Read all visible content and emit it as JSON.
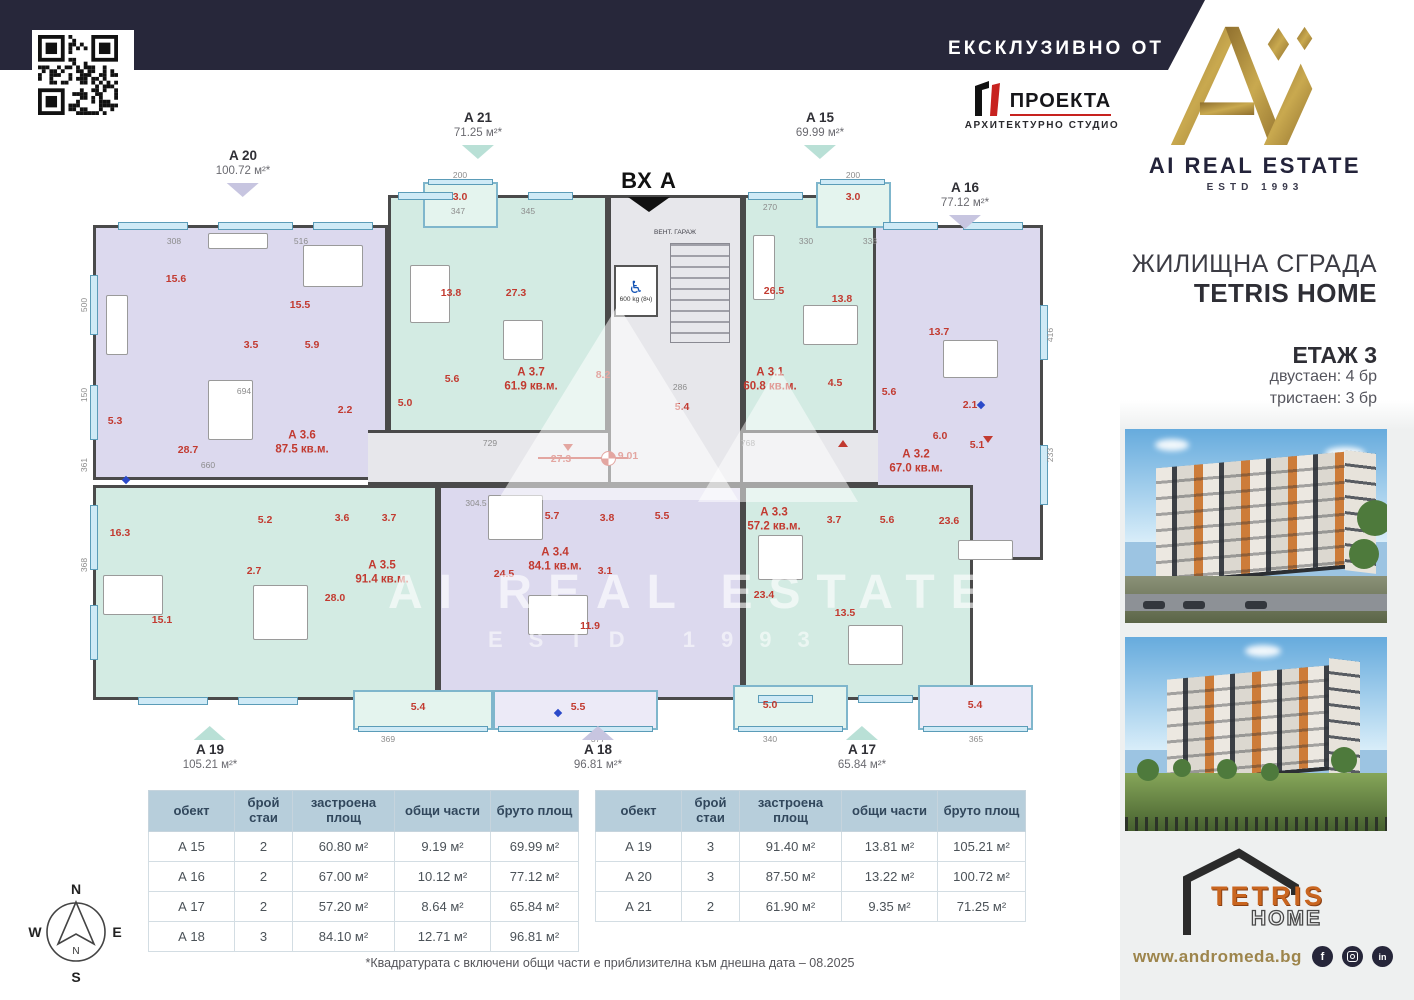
{
  "topbar": {
    "exclusive": "ЕКСКЛУЗИВНО ОТ"
  },
  "proekta": {
    "name": "ПРОЕКТА",
    "subtitle": "АРХИТЕКТУРНО СТУДИО"
  },
  "brand": {
    "name": "AI REAL ESTATE",
    "estd": "ESTD 1993"
  },
  "sidebar": {
    "title1": "ЖИЛИЩНА СГРАДА",
    "title2": "TETRIS HOME",
    "floor": "ЕТАЖ 3",
    "units_line1": "двустаен: 4 бр",
    "units_line2": "тристаен: 3 бр",
    "website": "www.andromeda.bg",
    "tetris": {
      "word1": "TETRIS",
      "word2": "HOME"
    },
    "socials": [
      {
        "name": "facebook",
        "glyph": "f"
      },
      {
        "name": "instagram",
        "glyph": ""
      },
      {
        "name": "linkedin",
        "glyph": "in"
      }
    ]
  },
  "plan": {
    "entrance": "ВХ А",
    "vent": "ВЕНТ. ГАРАЖ",
    "elevator": "600 kg (8ч)",
    "benchmark": "9.01",
    "watermark1": "AI REAL ESTATE",
    "watermark2": "ESTD 1993",
    "colors": {
      "teal": "#d3ebe3",
      "lavender": "#dcd9ee",
      "tealLight": "#e4f4ee",
      "lavenderLight": "#eceaf7",
      "corridor": "#e7e7eb",
      "wall": "#4a4a4a",
      "room": "#c23a30",
      "dim": "#8c8c8c",
      "markerTeal": "#b9e0d6",
      "markerLavender": "#c7c5e0"
    },
    "markers": [
      {
        "name": "A 20",
        "area": "100.72 м²*",
        "color": "lavender",
        "dir": "down",
        "x": 243,
        "y": 148
      },
      {
        "name": "A 21",
        "area": "71.25 м²*",
        "color": "teal",
        "dir": "down",
        "x": 478,
        "y": 110
      },
      {
        "name": "A 15",
        "area": "69.99 м²*",
        "color": "teal",
        "dir": "down",
        "x": 820,
        "y": 110
      },
      {
        "name": "A 16",
        "area": "77.12 м²*",
        "color": "lavender",
        "dir": "down",
        "x": 965,
        "y": 180
      },
      {
        "name": "A 19",
        "area": "105.21 м²*",
        "color": "teal",
        "dir": "up",
        "x": 210,
        "y": 722
      },
      {
        "name": "A 18",
        "area": "96.81 м²*",
        "color": "lavender",
        "dir": "up",
        "x": 598,
        "y": 722
      },
      {
        "name": "A 17",
        "area": "65.84 м²*",
        "color": "teal",
        "dir": "up",
        "x": 862,
        "y": 722
      }
    ],
    "units": [
      {
        "label": "А 3.6",
        "area": "87.5 кв.м.",
        "color": "lavender",
        "rect": [
          35,
          80,
          295,
          255
        ],
        "lx": 244,
        "ly": 298,
        "rooms": [
          {
            "v": "15.6",
            "x": 118,
            "y": 134
          },
          {
            "v": "15.5",
            "x": 242,
            "y": 160
          },
          {
            "v": "3.5",
            "x": 193,
            "y": 200
          },
          {
            "v": "5.9",
            "x": 254,
            "y": 200
          },
          {
            "v": "28.7",
            "x": 130,
            "y": 305
          },
          {
            "v": "5.3",
            "x": 57,
            "y": 276
          },
          {
            "v": "2.2",
            "x": 287,
            "y": 265
          }
        ]
      },
      {
        "label": "А 3.7",
        "area": "61.9 кв.м.",
        "color": "teal",
        "rect": [
          330,
          50,
          220,
          255
        ],
        "lx": 473,
        "ly": 235,
        "rooms": [
          {
            "v": "13.8",
            "x": 393,
            "y": 148
          },
          {
            "v": "27.3",
            "x": 458,
            "y": 148
          },
          {
            "v": "5.6",
            "x": 394,
            "y": 234
          },
          {
            "v": "5.0",
            "x": 347,
            "y": 258
          }
        ]
      },
      {
        "label": "А 3.1",
        "area": "60.8 кв.м.",
        "color": "teal",
        "rect": [
          685,
          50,
          145,
          255
        ],
        "lx": 712,
        "ly": 235,
        "rooms": [
          {
            "v": "26.5",
            "x": 716,
            "y": 146
          },
          {
            "v": "13.8",
            "x": 784,
            "y": 154
          },
          {
            "v": "4.5",
            "x": 777,
            "y": 238
          },
          {
            "v": "5.6",
            "x": 831,
            "y": 247
          }
        ]
      },
      {
        "label": "А 3.2",
        "area": "67.0 кв.м.",
        "color": "lavender",
        "rect": [
          815,
          80,
          170,
          335
        ],
        "lx": 858,
        "ly": 317,
        "rooms": [
          {
            "v": "13.7",
            "x": 881,
            "y": 187
          },
          {
            "v": "2.1",
            "x": 912,
            "y": 260
          },
          {
            "v": "6.0",
            "x": 882,
            "y": 291
          },
          {
            "v": "5.1",
            "x": 919,
            "y": 300
          },
          {
            "v": "23.6",
            "x": 891,
            "y": 376
          }
        ]
      },
      {
        "label": "А 3.5",
        "area": "91.4 кв.м.",
        "color": "teal",
        "rect": [
          35,
          340,
          345,
          215
        ],
        "lx": 324,
        "ly": 428,
        "rooms": [
          {
            "v": "16.3",
            "x": 62,
            "y": 388
          },
          {
            "v": "5.2",
            "x": 207,
            "y": 375
          },
          {
            "v": "3.6",
            "x": 284,
            "y": 373
          },
          {
            "v": "3.7",
            "x": 331,
            "y": 373
          },
          {
            "v": "2.7",
            "x": 196,
            "y": 426
          },
          {
            "v": "15.1",
            "x": 104,
            "y": 475
          },
          {
            "v": "28.0",
            "x": 277,
            "y": 453
          }
        ]
      },
      {
        "label": "А 3.4",
        "area": "84.1 кв.м.",
        "color": "lavender",
        "rect": [
          380,
          340,
          305,
          215
        ],
        "lx": 497,
        "ly": 415,
        "rooms": [
          {
            "v": "5.7",
            "x": 494,
            "y": 371
          },
          {
            "v": "3.8",
            "x": 549,
            "y": 373
          },
          {
            "v": "5.5",
            "x": 604,
            "y": 371
          },
          {
            "v": "24.5",
            "x": 446,
            "y": 429
          },
          {
            "v": "3.1",
            "x": 547,
            "y": 426
          },
          {
            "v": "11.9",
            "x": 532,
            "y": 481
          }
        ]
      },
      {
        "label": "А 3.3",
        "area": "57.2 кв.м.",
        "color": "teal",
        "rect": [
          685,
          340,
          230,
          215
        ],
        "lx": 716,
        "ly": 375,
        "rooms": [
          {
            "v": "3.7",
            "x": 776,
            "y": 375
          },
          {
            "v": "5.6",
            "x": 829,
            "y": 375
          },
          {
            "v": "23.4",
            "x": 706,
            "y": 450
          },
          {
            "v": "13.5",
            "x": 787,
            "y": 468
          }
        ]
      }
    ],
    "balconies": [
      {
        "v": "3.0",
        "color": "tealLight",
        "rect": [
          365,
          37,
          75,
          46
        ],
        "lx": 402,
        "ly": 52
      },
      {
        "v": "3.0",
        "color": "tealLight",
        "rect": [
          758,
          37,
          75,
          46
        ],
        "lx": 795,
        "ly": 52
      },
      {
        "v": "5.4",
        "color": "tealLight",
        "rect": [
          295,
          545,
          140,
          40
        ],
        "lx": 360,
        "ly": 562
      },
      {
        "v": "5.5",
        "color": "lavenderLight",
        "rect": [
          435,
          545,
          165,
          40
        ],
        "lx": 520,
        "ly": 562
      },
      {
        "v": "5.0",
        "color": "tealLight",
        "rect": [
          675,
          540,
          115,
          45
        ],
        "lx": 712,
        "ly": 560
      },
      {
        "v": "5.4",
        "color": "lavenderLight",
        "rect": [
          860,
          540,
          115,
          45
        ],
        "lx": 917,
        "ly": 560
      }
    ],
    "hall": {
      "rect": [
        310,
        285,
        510,
        55
      ],
      "labels": [
        {
          "v": "27.3",
          "x": 503,
          "y": 314
        },
        {
          "v": "9.01",
          "x": 570,
          "y": 311
        }
      ]
    },
    "core": {
      "rect": [
        550,
        50,
        135,
        290
      ],
      "labels": [
        {
          "v": "8.2",
          "x": 545,
          "y": 230
        },
        {
          "v": "5.4",
          "x": 624,
          "y": 262
        }
      ]
    },
    "dims": [
      {
        "v": "308",
        "x": 116,
        "y": 96
      },
      {
        "v": "516",
        "x": 243,
        "y": 96
      },
      {
        "v": "347",
        "x": 400,
        "y": 66
      },
      {
        "v": "345",
        "x": 470,
        "y": 66
      },
      {
        "v": "200",
        "x": 402,
        "y": 30
      },
      {
        "v": "200",
        "x": 795,
        "y": 30
      },
      {
        "v": "270",
        "x": 712,
        "y": 62
      },
      {
        "v": "330",
        "x": 748,
        "y": 96
      },
      {
        "v": "338",
        "x": 812,
        "y": 96
      },
      {
        "v": "286",
        "x": 622,
        "y": 242
      },
      {
        "v": "729",
        "x": 432,
        "y": 298
      },
      {
        "v": "768",
        "x": 690,
        "y": 298
      },
      {
        "v": "694",
        "x": 186,
        "y": 246
      },
      {
        "v": "660",
        "x": 150,
        "y": 320
      },
      {
        "v": "304.5",
        "x": 418,
        "y": 358
      },
      {
        "v": "369",
        "x": 330,
        "y": 594
      },
      {
        "v": "377",
        "x": 540,
        "y": 594
      },
      {
        "v": "340",
        "x": 712,
        "y": 594
      },
      {
        "v": "365",
        "x": 918,
        "y": 594
      },
      {
        "v": "150",
        "x": 26,
        "y": 250,
        "rot": true
      },
      {
        "v": "361",
        "x": 26,
        "y": 320,
        "rot": true
      },
      {
        "v": "368",
        "x": 26,
        "y": 420,
        "rot": true
      },
      {
        "v": "500",
        "x": 26,
        "y": 160,
        "rot": true
      },
      {
        "v": "416",
        "x": 992,
        "y": 190,
        "rot": true
      },
      {
        "v": "233",
        "x": 992,
        "y": 310,
        "rot": true
      }
    ]
  },
  "tables": [
    {
      "headers": [
        "обект",
        "брой стаи",
        "застроена площ",
        "общи части",
        "бруто площ"
      ],
      "rows": [
        [
          "А 15",
          "2",
          "60.80 м²",
          "9.19 м²",
          "69.99 м²"
        ],
        [
          "А 16",
          "2",
          "67.00 м²",
          "10.12 м²",
          "77.12 м²"
        ],
        [
          "А 17",
          "2",
          "57.20 м²",
          "8.64 м²",
          "65.84 м²"
        ],
        [
          "А 18",
          "3",
          "84.10 м²",
          "12.71 м²",
          "96.81 м²"
        ]
      ]
    },
    {
      "headers": [
        "обект",
        "брой стаи",
        "застроена площ",
        "общи части",
        "бруто площ"
      ],
      "rows": [
        [
          "А 19",
          "3",
          "91.40 м²",
          "13.81 м²",
          "105.21 м²"
        ],
        [
          "А 20",
          "3",
          "87.50 м²",
          "13.22 м²",
          "100.72 м²"
        ],
        [
          "А 21",
          "2",
          "61.90 м²",
          "9.35 м²",
          "71.25 м²"
        ]
      ]
    }
  ],
  "footnote": "*Квадратурата с включени общи части е приблизителна към днешна дата – 08.2025",
  "compass": {
    "n": "N",
    "e": "E",
    "s": "S",
    "w": "W"
  }
}
